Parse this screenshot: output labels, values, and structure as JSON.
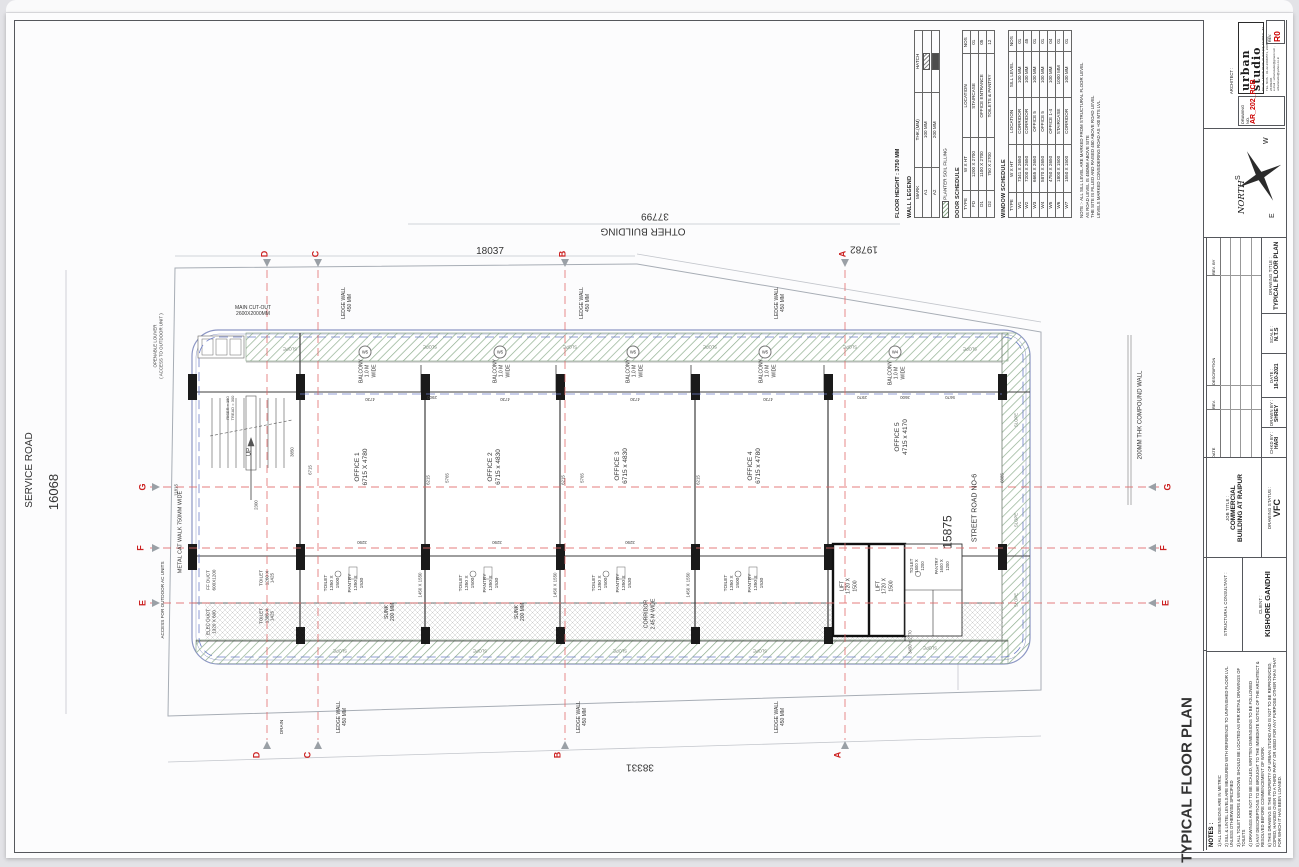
{
  "colors": {
    "accent_red": "#cc0000",
    "grid_red": "#e06868",
    "slab_blue": "#6e7ec9",
    "planter_green": "#8fae8f"
  },
  "titleblock": {
    "architect_label": "ARCHITECT :",
    "firm": "urban studio",
    "address_lines": [
      "NO.31, UNION PARK, KHAR (W), MUMBAI - 52",
      "TEL. NOS. : 91-22-26040571, 26055581, 26409206",
      "e-mail : urbanstudio@gmail.com , urbanstudio@yahoo.co.in"
    ],
    "drawing_no_label": "DRAWING NO.",
    "drawing_no": "AR_202_RCB",
    "rev_label": "REV.",
    "rev": "R0",
    "north_label": "NORTH",
    "compass_letters": [
      "W",
      "S",
      "E"
    ],
    "drawing_title_label": "DRAWING TITLE :",
    "drawing_title": "TYPICAL FLOOR PLAN",
    "scale_label": "SCALE :",
    "scale": "N.T.S",
    "date_label": "DATE :",
    "date": "18-10-2021",
    "drawn_label": "DRAWN BY :",
    "drawn_by": "SHREY",
    "chkd_label": "CHKD BY :",
    "chkd_by": "HARI",
    "rev_cols": [
      "DATE",
      "REV.",
      "DESCRIPTION",
      "REV. BY"
    ],
    "job_label": "JOB TITLE :",
    "job_line1": "COMMERCIAL",
    "job_line2": "BUILDING AT RAIPUR",
    "status_label": "DRAWING STATUS :",
    "status": "VFC",
    "structural_label": "STRUCTURAL CONSULTANT :",
    "client_label": "CLIENT :",
    "client": "KISHORE GANDHI"
  },
  "schedules": {
    "floor_height_label": "FLOOR HEIGHT : 3750 MM",
    "planter_label": "PLANTER SOIL FILLING",
    "wall_legend": {
      "title": "WALL LEGEND",
      "cols": [
        "MARK",
        "THK.(MM)",
        "HATCH"
      ],
      "rows": [
        [
          "A1",
          "100 MM",
          "@sw-a1"
        ],
        [
          "A2",
          "200 MM",
          "@sw-a2"
        ]
      ]
    },
    "door_schedule": {
      "title": "DOOR SCHEDULE",
      "cols": [
        "TYPE",
        "W X HT",
        "LOCATION",
        "NOS"
      ],
      "rows": [
        [
          "FD",
          "1200 X 2700",
          "STAIRCASE",
          "01"
        ],
        [
          "D1",
          "1100 X 2700",
          "OFFICE ENTRANCE",
          "05"
        ],
        [
          "D2",
          "750 X 2700",
          "TOILETS & PANTRY",
          "12"
        ]
      ]
    },
    "window_schedule": {
      "title": "WINDOW SCHEDULE",
      "cols": [
        "TYPE",
        "W X HT",
        "LOCATION",
        "SILL LEVEL",
        "NOS"
      ],
      "rows": [
        [
          "W1",
          "7341 X 2650",
          "CORRIDOR",
          "100 MM",
          "01"
        ],
        [
          "W2",
          "7200 X 2650",
          "CORRIDOR",
          "100 MM",
          "45"
        ],
        [
          "W3",
          "6665 X 2650",
          "OFFICE 5",
          "100 MM",
          "01"
        ],
        [
          "W4",
          "5870 X 2650",
          "OFFICE 5",
          "100 MM",
          "01"
        ],
        [
          "W5",
          "4750 X 2650",
          "OFFICE 1-4",
          "100 MM",
          "04"
        ],
        [
          "W6",
          "1800 X 1500",
          "STAIRCASE",
          "1000 MM",
          "01"
        ],
        [
          "W7",
          "1550 X 1500",
          "CORRIDOR",
          "100 MM",
          "01"
        ]
      ]
    },
    "note_lines": [
      "NOTE :-  ALL SILL LEVEL ARE MARKED FROM STRUCTURAL FLOOR LEVEL",
      "AS ROAD LEVEL IS 450MM ABOVE SITE",
      "THE SITE IS FILLED AND RAISED 450 ABOVE ROAD LEVEL",
      "LEVELS MARKED CONSIDERING ROAD AS +00 MTS LVL"
    ]
  },
  "notes": {
    "heading": "NOTES :",
    "items": [
      "1) ALL DIMENSIONS ARE IN METRIC",
      "2) SILL & LINTEL LEVELS ARE MEASURED WITH REFERENCE TO UNFINISHED FLOOR LVL. UNLESS OTHERWISE SPECIFIED",
      "3) ALL TOILET DOORS & WINDOWS SHOULD BE LOCATED AS PER DETAIL DRAWINGS OF TOILETS",
      "4) DRAWINGS ARE NOT TO BE SCALED, WRITTEN DIMENSIONS TO BE FOLLOWED",
      "5) ANY DESCREPTIONS TO BE BROUGHT TO THE IMMEDIATE NOTICE OF THE ARCHITECT & RESOLVED BEFORE COMMENCEMENT OF WORK",
      "6) THIS DRAWING IS THE PROPERTY OF URBAN STUDIO AND IS NOT TO BE REPRODUCED, COPIED, HANDED OVER TO A THIRD PARTY OR USED FOR ANY PURPOSE OTHER THAN THAT FOR WHICH IT HAS BEEN LOANED."
    ]
  },
  "plan_labels": [
    {
      "t": "SERVICE ROAD",
      "x": 30,
      "y": 470,
      "r": -90,
      "s": 10,
      "n": "service-road-label"
    },
    {
      "t": "16068",
      "x": 54,
      "y": 492,
      "r": -90,
      "s": 13,
      "n": "dim-16068"
    },
    {
      "t": "OTHER BUILDING",
      "x": 643,
      "y": 230,
      "r": 180,
      "s": 10,
      "n": "other-building-label"
    },
    {
      "t": "37799",
      "x": 655,
      "y": 215,
      "r": 180,
      "s": 10,
      "n": "dim-37799"
    },
    {
      "t": "18037",
      "x": 490,
      "y": 252,
      "r": 0,
      "s": 10,
      "n": "dim-18037"
    },
    {
      "t": "19782",
      "x": 864,
      "y": 248,
      "r": 180,
      "s": 10,
      "n": "dim-19782"
    },
    {
      "t": "38331",
      "x": 640,
      "y": 766,
      "r": 180,
      "s": 10,
      "n": "dim-38331"
    },
    {
      "t": "15875",
      "x": 948,
      "y": 532,
      "r": -90,
      "s": 12,
      "n": "dim-15875"
    },
    {
      "t": "STREET ROAD NO-6",
      "x": 976,
      "y": 508,
      "r": -90,
      "s": 7,
      "n": "street-road-label"
    },
    {
      "t": "200MM THK COMPOUND WALL",
      "x": 1141,
      "y": 415,
      "r": -90,
      "s": 6,
      "n": "compound-wall-label"
    },
    {
      "t": "TYPICAL FLOOR PLAN",
      "x": 1188,
      "y": 780,
      "r": -90,
      "s": 15,
      "b": true,
      "n": "plan-title"
    },
    {
      "t": "OFFICE 1\n6715 X 4780",
      "x": 362,
      "y": 467,
      "r": -90,
      "s": 6.5,
      "n": "office-1-label"
    },
    {
      "t": "OFFICE 2\n6715 x 4830",
      "x": 495,
      "y": 467,
      "r": -90,
      "s": 6.5,
      "n": "office-2-label"
    },
    {
      "t": "OFFICE 3\n6715 x 4830",
      "x": 622,
      "y": 466,
      "r": -90,
      "s": 6.5,
      "n": "office-3-label"
    },
    {
      "t": "OFFICE 4\n6715 x 4780",
      "x": 755,
      "y": 466,
      "r": -90,
      "s": 6.5,
      "n": "office-4-label"
    },
    {
      "t": "OFFICE 5\n4715 x 4170",
      "x": 902,
      "y": 437,
      "r": -90,
      "s": 6.5,
      "n": "office-5-label"
    },
    {
      "t": "BALCONY\n1.0 M\nWIDE",
      "x": 368,
      "y": 371,
      "r": -90,
      "s": 5,
      "n": "balcony-label"
    },
    {
      "t": "BALCONY\n1.0 M\nWIDE",
      "x": 502,
      "y": 371,
      "r": -90,
      "s": 5,
      "n": "balcony-label"
    },
    {
      "t": "BALCONY\n1.0 M\nWIDE",
      "x": 635,
      "y": 371,
      "r": -90,
      "s": 5,
      "n": "balcony-label"
    },
    {
      "t": "BALCONY\n1.0 M\nWIDE",
      "x": 768,
      "y": 371,
      "r": -90,
      "s": 5,
      "n": "balcony-label"
    },
    {
      "t": "BALCONY\n1.0 M\nWIDE",
      "x": 897,
      "y": 373,
      "r": -90,
      "s": 5,
      "n": "balcony-label"
    },
    {
      "t": "TOILET\n1350 X\n1500",
      "x": 333,
      "y": 583,
      "r": -90,
      "s": 4.8,
      "n": "toilet-label"
    },
    {
      "t": "TOILET\n1350 X\n1500",
      "x": 468,
      "y": 583,
      "r": -90,
      "s": 4.8,
      "n": "toilet-label"
    },
    {
      "t": "TOILET\n1350 X\n1500",
      "x": 601,
      "y": 583,
      "r": -90,
      "s": 4.8,
      "n": "toilet-label"
    },
    {
      "t": "TOILET\n1350 X\n1500",
      "x": 733,
      "y": 583,
      "r": -90,
      "s": 4.8,
      "n": "toilet-label"
    },
    {
      "t": "PANTRY\n1350 X\n1530",
      "x": 357,
      "y": 583,
      "r": -90,
      "s": 4.8,
      "n": "pantry-label"
    },
    {
      "t": "PANTRY\n1350 X\n1530",
      "x": 492,
      "y": 583,
      "r": -90,
      "s": 4.8,
      "n": "pantry-label"
    },
    {
      "t": "PANTRY\n1350 X\n1530",
      "x": 625,
      "y": 583,
      "r": -90,
      "s": 4.8,
      "n": "pantry-label"
    },
    {
      "t": "PANTRY\n1350 X\n1530",
      "x": 757,
      "y": 583,
      "r": -90,
      "s": 4.8,
      "n": "pantry-label"
    },
    {
      "t": "SUNK\n200 MM",
      "x": 390,
      "y": 612,
      "r": -90,
      "s": 5,
      "n": "sunk-label"
    },
    {
      "t": "SUNK\n200 MM",
      "x": 520,
      "y": 612,
      "r": -90,
      "s": 5,
      "n": "sunk-label"
    },
    {
      "t": "1450 X 1550",
      "x": 420,
      "y": 585,
      "r": -90,
      "s": 4.4,
      "c": "#444",
      "n": "dim-label"
    },
    {
      "t": "1450 X 1550",
      "x": 555,
      "y": 585,
      "r": -90,
      "s": 4.4,
      "c": "#444",
      "n": "dim-label"
    },
    {
      "t": "1450 X 1550",
      "x": 688,
      "y": 585,
      "r": -90,
      "s": 4.4,
      "c": "#444",
      "n": "dim-label"
    },
    {
      "t": "CORRIDOR\n2.45 M WIDE",
      "x": 650,
      "y": 614,
      "r": -90,
      "s": 5.2,
      "n": "corridor-label"
    },
    {
      "t": "LIFT\n1720 X\n1500",
      "x": 849,
      "y": 586,
      "r": -90,
      "s": 5,
      "n": "lift-label"
    },
    {
      "t": "LIFT\n1720 X\n1500",
      "x": 885,
      "y": 586,
      "r": -90,
      "s": 5,
      "n": "lift-label"
    },
    {
      "t": "TOILET\n1500 X\n1200",
      "x": 917,
      "y": 566,
      "r": -90,
      "s": 4.2,
      "n": "toilet-label"
    },
    {
      "t": "PANTRY\n1600 X\n1200",
      "x": 942,
      "y": 566,
      "r": -90,
      "s": 4.2,
      "n": "pantry-label"
    },
    {
      "t": "3450 + 2770",
      "x": 910,
      "y": 642,
      "r": -90,
      "s": 4.2,
      "c": "#444",
      "n": "dim-label"
    },
    {
      "t": "TOILET\n1260 X\n1425",
      "x": 267,
      "y": 578,
      "r": -90,
      "s": 4.6,
      "n": "toilet-label"
    },
    {
      "t": "TOILET\n1385 X\n1425",
      "x": 267,
      "y": 616,
      "r": -90,
      "s": 4.6,
      "n": "toilet-label"
    },
    {
      "t": "FF DUCT\n600X1200",
      "x": 211,
      "y": 580,
      "r": -90,
      "s": 4.6,
      "n": "ff-duct-label"
    },
    {
      "t": "ELEC DUCT\n1320 X 600",
      "x": 211,
      "y": 622,
      "r": -90,
      "s": 4.6,
      "n": "elec-duct-label"
    },
    {
      "t": "UP",
      "x": 250,
      "y": 452,
      "r": -90,
      "s": 6,
      "n": "stair-up-label"
    },
    {
      "t": "RISER = 150\nTREAD = 300",
      "x": 230,
      "y": 408,
      "r": -90,
      "s": 4,
      "c": "#444",
      "n": "stair-note"
    },
    {
      "t": "METAL CAT WALK 750MM WIDE",
      "x": 181,
      "y": 532,
      "r": -90,
      "s": 5.5,
      "n": "catwalk-label"
    },
    {
      "t": "LEDGE WALL\n450 MM",
      "x": 347,
      "y": 303,
      "r": -90,
      "s": 5,
      "n": "ledge-wall-label"
    },
    {
      "t": "LEDGE WALL\n450 MM",
      "x": 585,
      "y": 303,
      "r": -90,
      "s": 5,
      "n": "ledge-wall-label"
    },
    {
      "t": "LEDGE WALL\n450 MM",
      "x": 780,
      "y": 303,
      "r": -90,
      "s": 5,
      "n": "ledge-wall-label"
    },
    {
      "t": "LEDGE WALL\n450 MM",
      "x": 342,
      "y": 717,
      "r": -90,
      "s": 5,
      "n": "ledge-wall-label"
    },
    {
      "t": "LEDGE WALL\n450 MM",
      "x": 582,
      "y": 717,
      "r": -90,
      "s": 5,
      "n": "ledge-wall-label"
    },
    {
      "t": "LEDGE WALL\n450 MM",
      "x": 780,
      "y": 717,
      "r": -90,
      "s": 5,
      "n": "ledge-wall-label"
    },
    {
      "t": "MAIN CUT-OUT\n2600X2000MM",
      "x": 253,
      "y": 311,
      "r": 0,
      "s": 5,
      "n": "cutout-label"
    },
    {
      "t": "OPENABLE LOUVER\n( ACCESS TO OUTDOOR UNIT )",
      "x": 158,
      "y": 346,
      "r": -90,
      "s": 4.4,
      "n": "louver-label"
    },
    {
      "t": "ACCESS FOR OUTDOOR AC UNITS",
      "x": 163,
      "y": 600,
      "r": -90,
      "s": 4.6,
      "n": "access-label"
    },
    {
      "t": "DRAIN",
      "x": 282,
      "y": 727,
      "r": -90,
      "s": 4.6,
      "n": "drain-label"
    },
    {
      "t": "D",
      "x": 265,
      "y": 254,
      "r": -90,
      "s": 9,
      "c": "#cc2222",
      "b": true,
      "n": "grid-letter"
    },
    {
      "t": "C",
      "x": 316,
      "y": 254,
      "r": -90,
      "s": 9,
      "c": "#cc2222",
      "b": true,
      "n": "grid-letter"
    },
    {
      "t": "B",
      "x": 563,
      "y": 254,
      "r": -90,
      "s": 9,
      "c": "#cc2222",
      "b": true,
      "n": "grid-letter"
    },
    {
      "t": "A",
      "x": 843,
      "y": 254,
      "r": -90,
      "s": 9,
      "c": "#cc2222",
      "b": true,
      "n": "grid-letter"
    },
    {
      "t": "D",
      "x": 257,
      "y": 755,
      "r": -90,
      "s": 9,
      "c": "#cc2222",
      "b": true,
      "n": "grid-letter"
    },
    {
      "t": "C",
      "x": 308,
      "y": 755,
      "r": -90,
      "s": 9,
      "c": "#cc2222",
      "b": true,
      "n": "grid-letter"
    },
    {
      "t": "B",
      "x": 558,
      "y": 755,
      "r": -90,
      "s": 9,
      "c": "#cc2222",
      "b": true,
      "n": "grid-letter"
    },
    {
      "t": "A",
      "x": 838,
      "y": 755,
      "r": -90,
      "s": 9,
      "c": "#cc2222",
      "b": true,
      "n": "grid-letter"
    },
    {
      "t": "G",
      "x": 143,
      "y": 487,
      "r": -90,
      "s": 9,
      "c": "#cc2222",
      "b": true,
      "n": "grid-letter"
    },
    {
      "t": "F",
      "x": 141,
      "y": 548,
      "r": -90,
      "s": 9,
      "c": "#cc2222",
      "b": true,
      "n": "grid-letter"
    },
    {
      "t": "E",
      "x": 143,
      "y": 603,
      "r": -90,
      "s": 9,
      "c": "#cc2222",
      "b": true,
      "n": "grid-letter"
    },
    {
      "t": "G",
      "x": 1168,
      "y": 487,
      "r": -90,
      "s": 9,
      "c": "#cc2222",
      "b": true,
      "n": "grid-letter"
    },
    {
      "t": "F",
      "x": 1164,
      "y": 548,
      "r": -90,
      "s": 9,
      "c": "#cc2222",
      "b": true,
      "n": "grid-letter"
    },
    {
      "t": "E",
      "x": 1166,
      "y": 603,
      "r": -90,
      "s": 9,
      "c": "#cc2222",
      "b": true,
      "n": "grid-letter"
    },
    {
      "t": "4730",
      "x": 370,
      "y": 399,
      "r": 180,
      "s": 4.4,
      "c": "#444",
      "n": "dim-label"
    },
    {
      "t": "4730",
      "x": 505,
      "y": 399,
      "r": 180,
      "s": 4.4,
      "c": "#444",
      "n": "dim-label"
    },
    {
      "t": "4730",
      "x": 635,
      "y": 399,
      "r": 180,
      "s": 4.4,
      "c": "#444",
      "n": "dim-label"
    },
    {
      "t": "4730",
      "x": 768,
      "y": 399,
      "r": 180,
      "s": 4.4,
      "c": "#444",
      "n": "dim-label"
    },
    {
      "t": "2900",
      "x": 432,
      "y": 397,
      "r": 180,
      "s": 4.4,
      "c": "#444",
      "n": "dim-label"
    },
    {
      "t": "2970",
      "x": 862,
      "y": 397,
      "r": 180,
      "s": 4.4,
      "c": "#444",
      "n": "dim-label"
    },
    {
      "t": "3600",
      "x": 905,
      "y": 397,
      "r": 180,
      "s": 4.4,
      "c": "#444",
      "n": "dim-label"
    },
    {
      "t": "5670",
      "x": 950,
      "y": 397,
      "r": 180,
      "s": 4.4,
      "c": "#444",
      "n": "dim-label"
    },
    {
      "t": "6215",
      "x": 428,
      "y": 480,
      "r": -90,
      "s": 4.4,
      "c": "#444",
      "n": "dim-label"
    },
    {
      "t": "6215",
      "x": 563,
      "y": 480,
      "r": -90,
      "s": 4.4,
      "c": "#444",
      "n": "dim-label"
    },
    {
      "t": "6215",
      "x": 698,
      "y": 480,
      "r": -90,
      "s": 4.4,
      "c": "#444",
      "n": "dim-label"
    },
    {
      "t": "5765",
      "x": 447,
      "y": 478,
      "r": -90,
      "s": 4.4,
      "c": "#444",
      "n": "dim-label"
    },
    {
      "t": "5765",
      "x": 582,
      "y": 478,
      "r": -90,
      "s": 4.4,
      "c": "#444",
      "n": "dim-label"
    },
    {
      "t": "6715",
      "x": 310,
      "y": 470,
      "r": -90,
      "s": 4.4,
      "c": "#444",
      "n": "dim-label"
    },
    {
      "t": "6885",
      "x": 1002,
      "y": 478,
      "r": -90,
      "s": 4.4,
      "c": "#444",
      "n": "dim-label"
    },
    {
      "t": "11815",
      "x": 176,
      "y": 490,
      "r": -90,
      "s": 4.4,
      "c": "#444",
      "n": "dim-label"
    },
    {
      "t": "3850",
      "x": 292,
      "y": 452,
      "r": -90,
      "s": 4.4,
      "c": "#444",
      "n": "dim-label"
    },
    {
      "t": "2300",
      "x": 256,
      "y": 505,
      "r": -90,
      "s": 4.4,
      "c": "#444",
      "n": "dim-label"
    },
    {
      "t": "3290",
      "x": 362,
      "y": 542,
      "r": 180,
      "s": 4.4,
      "c": "#444",
      "n": "dim-label"
    },
    {
      "t": "3290",
      "x": 497,
      "y": 542,
      "r": 180,
      "s": 4.4,
      "c": "#444",
      "n": "dim-label"
    },
    {
      "t": "3290",
      "x": 630,
      "y": 542,
      "r": 180,
      "s": 4.4,
      "c": "#444",
      "n": "dim-label"
    },
    {
      "t": "W5",
      "x": 365,
      "y": 352,
      "r": 0,
      "s": 4.2,
      "cls": "tag",
      "n": "window-tag"
    },
    {
      "t": "W5",
      "x": 500,
      "y": 352,
      "r": 0,
      "s": 4.2,
      "cls": "tag",
      "n": "window-tag"
    },
    {
      "t": "W5",
      "x": 633,
      "y": 352,
      "r": 0,
      "s": 4.2,
      "cls": "tag",
      "n": "window-tag"
    },
    {
      "t": "W5",
      "x": 765,
      "y": 352,
      "r": 0,
      "s": 4.2,
      "cls": "tag",
      "n": "window-tag"
    },
    {
      "t": "W4",
      "x": 895,
      "y": 352,
      "r": 0,
      "s": 4.2,
      "cls": "tag",
      "n": "window-tag"
    },
    {
      "t": "SLOPE",
      "x": 290,
      "y": 349,
      "r": 180,
      "s": 4.2,
      "c": "#6a7a6a",
      "n": "slope-label"
    },
    {
      "t": "SLOPE",
      "x": 430,
      "y": 347,
      "r": 180,
      "s": 4.2,
      "c": "#6a7a6a",
      "n": "slope-label"
    },
    {
      "t": "SLOPE",
      "x": 570,
      "y": 347,
      "r": 180,
      "s": 4.2,
      "c": "#6a7a6a",
      "n": "slope-label"
    },
    {
      "t": "SLOPE",
      "x": 710,
      "y": 347,
      "r": 180,
      "s": 4.2,
      "c": "#6a7a6a",
      "n": "slope-label"
    },
    {
      "t": "SLOPE",
      "x": 850,
      "y": 347,
      "r": 180,
      "s": 4.2,
      "c": "#6a7a6a",
      "n": "slope-label"
    },
    {
      "t": "SLOPE",
      "x": 970,
      "y": 349,
      "r": 180,
      "s": 4.2,
      "c": "#6a7a6a",
      "n": "slope-label"
    },
    {
      "t": "SLOPE",
      "x": 340,
      "y": 651,
      "r": 180,
      "s": 4.2,
      "c": "#6a7a6a",
      "n": "slope-label"
    },
    {
      "t": "SLOPE",
      "x": 480,
      "y": 651,
      "r": 180,
      "s": 4.2,
      "c": "#6a7a6a",
      "n": "slope-label"
    },
    {
      "t": "SLOPE",
      "x": 620,
      "y": 651,
      "r": 180,
      "s": 4.2,
      "c": "#6a7a6a",
      "n": "slope-label"
    },
    {
      "t": "SLOPE",
      "x": 760,
      "y": 651,
      "r": 180,
      "s": 4.2,
      "c": "#6a7a6a",
      "n": "slope-label"
    },
    {
      "t": "SLOPE",
      "x": 930,
      "y": 648,
      "r": 180,
      "s": 4.2,
      "c": "#6a7a6a",
      "n": "slope-label"
    },
    {
      "t": "SLOPE",
      "x": 1016,
      "y": 420,
      "r": -90,
      "s": 4.2,
      "c": "#6a7a6a",
      "n": "slope-label"
    },
    {
      "t": "SLOPE",
      "x": 1016,
      "y": 520,
      "r": -90,
      "s": 4.2,
      "c": "#6a7a6a",
      "n": "slope-label"
    },
    {
      "t": "SLOPE",
      "x": 1016,
      "y": 600,
      "r": -90,
      "s": 4.2,
      "c": "#6a7a6a",
      "n": "slope-label"
    }
  ]
}
